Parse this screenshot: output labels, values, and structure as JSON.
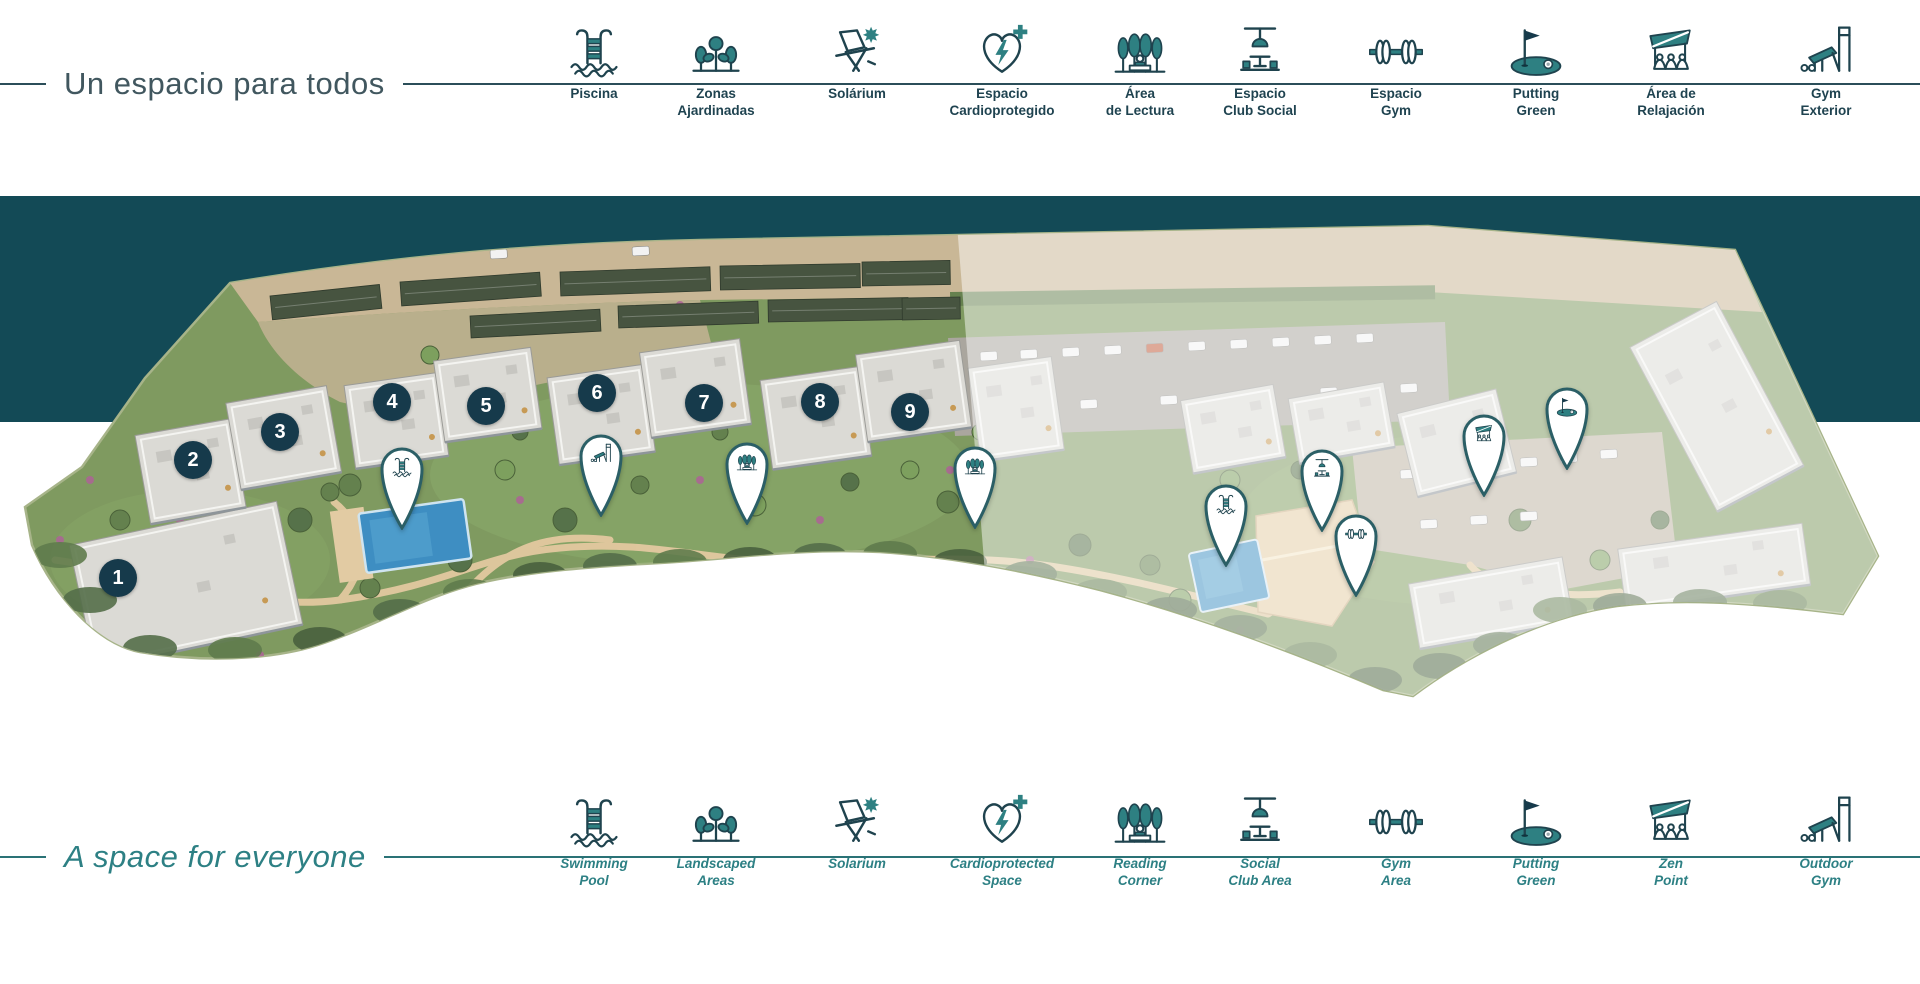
{
  "header": {
    "title": "Un espacio para todos",
    "items": [
      {
        "icon": "swimming-pool",
        "label": "Piscina",
        "x": 594
      },
      {
        "icon": "landscaped-areas",
        "label": "Zonas\nAjardinadas",
        "x": 716
      },
      {
        "icon": "solarium",
        "label": "Solárium",
        "x": 857
      },
      {
        "icon": "cardioprotected",
        "label": "Espacio\nCardioprotegido",
        "x": 1002
      },
      {
        "icon": "reading-corner",
        "label": "Área\nde Lectura",
        "x": 1140
      },
      {
        "icon": "social-club",
        "label": "Espacio\nClub Social",
        "x": 1260
      },
      {
        "icon": "gym",
        "label": "Espacio\nGym",
        "x": 1396
      },
      {
        "icon": "putting-green",
        "label": "Putting\nGreen",
        "x": 1536
      },
      {
        "icon": "zen-point",
        "label": "Área de\nRelajación",
        "x": 1671
      },
      {
        "icon": "outdoor-gym",
        "label": "Gym\nExterior",
        "x": 1826
      }
    ]
  },
  "footer": {
    "title": "A space for everyone",
    "items": [
      {
        "icon": "swimming-pool",
        "label": "Swimming\nPool",
        "x": 594
      },
      {
        "icon": "landscaped-areas",
        "label": "Landscaped\nAreas",
        "x": 716
      },
      {
        "icon": "solarium",
        "label": "Solarium",
        "x": 857
      },
      {
        "icon": "cardioprotected",
        "label": "Cardioprotected\nSpace",
        "x": 1002
      },
      {
        "icon": "reading-corner",
        "label": "Reading\nCorner",
        "x": 1140
      },
      {
        "icon": "social-club",
        "label": "Social\nClub Area",
        "x": 1260
      },
      {
        "icon": "gym",
        "label": "Gym\nArea",
        "x": 1396
      },
      {
        "icon": "putting-green",
        "label": "Putting\nGreen",
        "x": 1536
      },
      {
        "icon": "zen-point",
        "label": "Zen\nPoint",
        "x": 1671
      },
      {
        "icon": "outdoor-gym",
        "label": "Outdoor\nGym",
        "x": 1826
      }
    ]
  },
  "map": {
    "building_markers": [
      {
        "number": "1",
        "x": 118,
        "y": 578
      },
      {
        "number": "2",
        "x": 193,
        "y": 460
      },
      {
        "number": "3",
        "x": 280,
        "y": 432
      },
      {
        "number": "4",
        "x": 392,
        "y": 402
      },
      {
        "number": "5",
        "x": 486,
        "y": 406
      },
      {
        "number": "6",
        "x": 597,
        "y": 393
      },
      {
        "number": "7",
        "x": 704,
        "y": 403
      },
      {
        "number": "8",
        "x": 820,
        "y": 402
      },
      {
        "number": "9",
        "x": 910,
        "y": 412
      }
    ],
    "pins": [
      {
        "icon": "swimming-pool",
        "x": 402,
        "y": 530
      },
      {
        "icon": "outdoor-gym",
        "x": 601,
        "y": 517
      },
      {
        "icon": "reading-corner",
        "x": 747,
        "y": 525
      },
      {
        "icon": "reading-corner",
        "x": 975,
        "y": 529
      },
      {
        "icon": "swimming-pool",
        "x": 1226,
        "y": 567
      },
      {
        "icon": "social-club",
        "x": 1322,
        "y": 532
      },
      {
        "icon": "gym",
        "x": 1356,
        "y": 597
      },
      {
        "icon": "zen-point",
        "x": 1484,
        "y": 497
      },
      {
        "icon": "putting-green",
        "x": 1567,
        "y": 470
      }
    ]
  },
  "colors": {
    "band": "#134a56",
    "accent_teal": "#2e8082",
    "icon_stroke": "#1f434e",
    "marker_navy": "#163a4b",
    "footer_teal": "#2d8084",
    "top_rule": "#2b4e59"
  }
}
